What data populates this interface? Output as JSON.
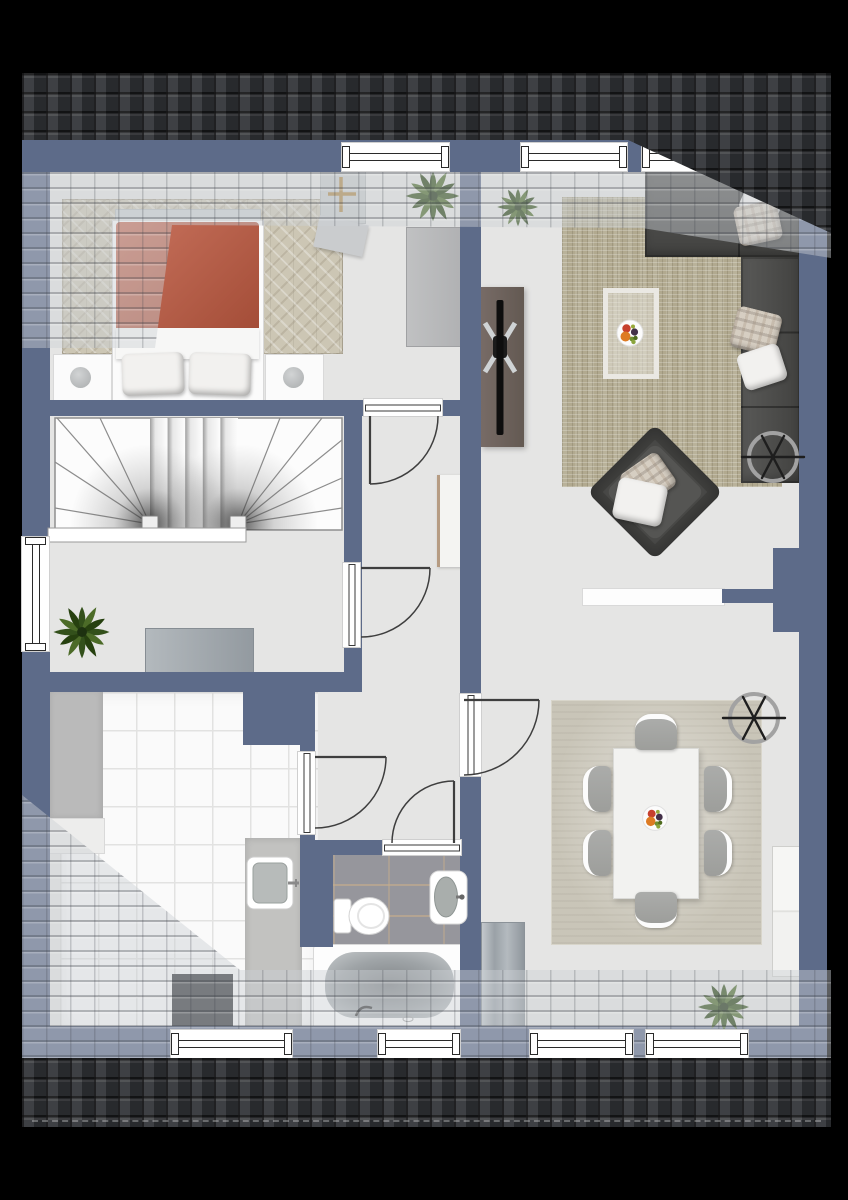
{
  "app": {
    "type": "floor-plan-top-view-rendering",
    "scene": "upper floor of a house with pitched roof overhangs",
    "background": "#000000"
  },
  "palette": {
    "wall": "#5d6b89",
    "floor": "#e5e5e4",
    "roofDark": "#323438",
    "roofOverlay": "rgba(205,208,213,0.45)",
    "duvet": "#bf5a41",
    "sofa": "#4b4b49",
    "rugLiving": "#b1a98f",
    "rugBedroom": "#ccc6b4",
    "rugDining": "#c9c5b8",
    "bathTile": "#96969c",
    "kitchenTile": "#fafafa",
    "tvBoard": "#6f6460",
    "counter": "#bababa",
    "matDark": "#33363a",
    "cabinetGray": "#a9b0b5",
    "wood": "#b69c83",
    "plant": "#3c5520",
    "white": "#ffffff",
    "lineDark": "#3a3a3a"
  },
  "rooms": [
    {
      "id": "bedroom",
      "label": "Bedroom",
      "furniture": [
        "double-bed",
        "orange-duvet",
        "two-pillows",
        "nightstand-left",
        "nightstand-right",
        "bench",
        "wardrobe",
        "desk",
        "desk-chair",
        "herringbone-rug",
        "plant"
      ]
    },
    {
      "id": "stair-room",
      "label": "Stair room",
      "furniture": [
        "winder-staircase",
        "sideboard",
        "plant"
      ]
    },
    {
      "id": "kitchen",
      "label": "Kitchen",
      "furniture": [
        "counter-left",
        "counter-right",
        "sink",
        "dark-mat"
      ]
    },
    {
      "id": "bathroom",
      "label": "Bathroom",
      "furniture": [
        "toilet",
        "washbasin",
        "bathtub"
      ]
    },
    {
      "id": "hallway",
      "label": "Hallway",
      "furniture": [
        "shelf"
      ]
    },
    {
      "id": "living-room",
      "label": "Living room",
      "furniture": [
        "corner-sofa",
        "pillows",
        "armchair",
        "tv-sideboard",
        "tv",
        "textured-rug",
        "art-rug-inset",
        "fruit-bowl",
        "ceiling-fan",
        "white-sideboard",
        "plant"
      ]
    },
    {
      "id": "dining-room",
      "label": "Dining room",
      "furniture": [
        "dining-table",
        "six-chairs",
        "rug",
        "fruit-bowl",
        "ceiling-fan",
        "tall-cabinet",
        "low-cabinet",
        "plant"
      ]
    }
  ],
  "counts": {
    "windows": 8,
    "interior_doors": 5,
    "plants": 4,
    "ceiling_fans": 2,
    "dining_chairs": 6,
    "fruit_bowls": 2
  },
  "roof": {
    "dark_band_top": true,
    "dark_band_bottom": true,
    "translucent_overhang_top": true,
    "translucent_overhang_bottom": true,
    "hip_corner_top_right": true
  }
}
